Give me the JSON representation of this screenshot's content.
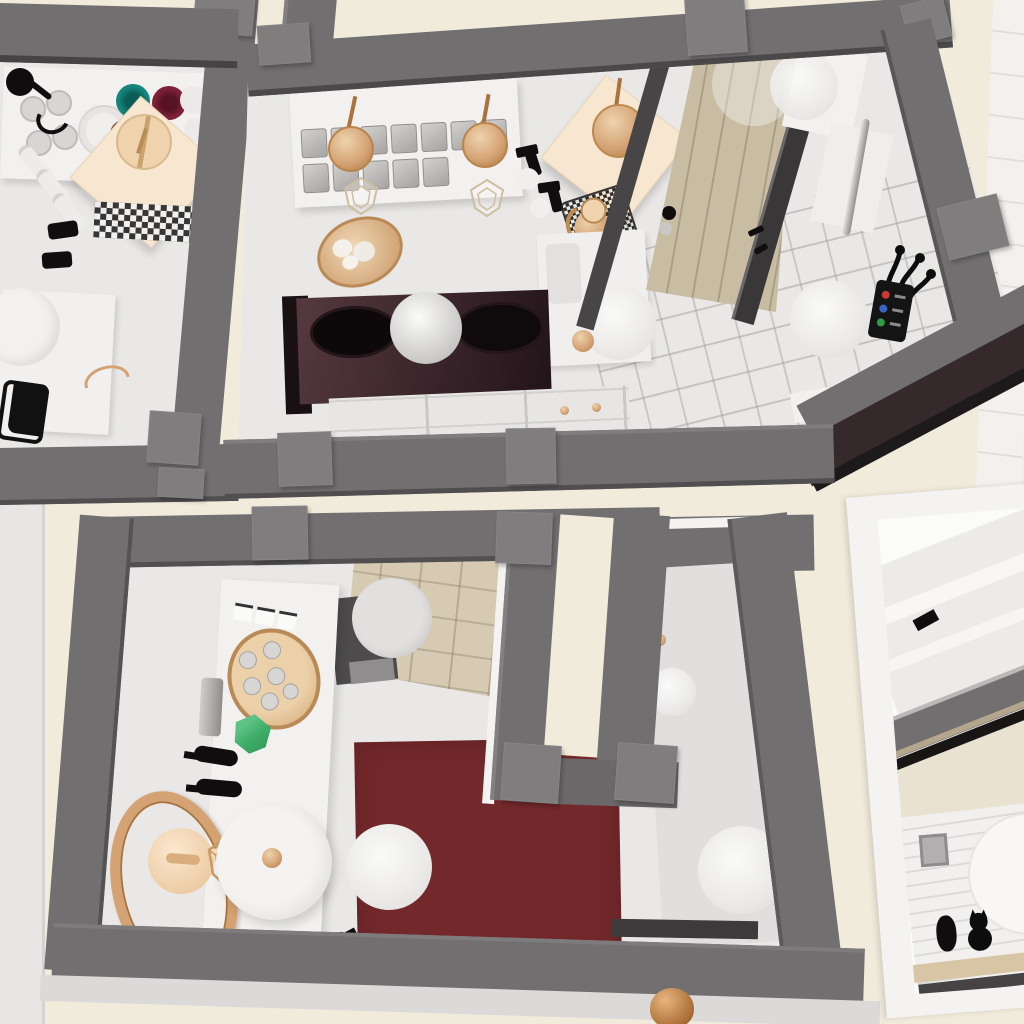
{
  "scene": {
    "type": "3d-interior-render-top-down",
    "setting": "Top-down 3D render of a miniature cafe interior with gray walls, cream floors, copper accents, a dark red rug and a tan door",
    "colors": {
      "floor_cream": "#f1ebdc",
      "exterior_white": "#f2f1ed",
      "wall_top": "#716f70",
      "wall_side": "#4b494a",
      "wall_cap": "#7f7d7e",
      "wall_dark": "#39383a",
      "room_floor": "#e9e8e6",
      "cutout_floor": "#e0dfdd",
      "counter_white": "#f2f1ef",
      "cabinet_white": "#e7e6e4",
      "dark_counter_a": "#55393f",
      "dark_counter_b": "#22141a",
      "black": "#0f0d0e",
      "door_tan": "#c8bca3",
      "door_frame": "#474546",
      "copper": "#d3a172",
      "copper_light": "#eed3ad",
      "copper_deep": "#a9733f",
      "cream_table": "#f8e7d0",
      "teal": "#16857c",
      "maroon": "#7c2137",
      "brown": "#8a5a35",
      "cream_cup": "#efe3c2",
      "green_gem": "#3fae6a",
      "rug_red": "#73282b",
      "beige_tile": "#d7cab2",
      "silver": "#b9b8b6",
      "glass": "#c9c8c6",
      "frame_white": "#f4f3f1",
      "panel_cream": "#e9e2d1",
      "btn_red": "#c43b34",
      "btn_blue": "#3565c0",
      "btn_green": "#2f9e44"
    },
    "rooms": [
      {
        "name": "pantry-room",
        "position": "top-left",
        "objects": [
          "white shelf with glasses and plate stack",
          "teal cup",
          "maroon cup",
          "brown cup",
          "cream cup",
          "white cups",
          "cream square table",
          "wooden stool",
          "black faucet",
          "black-white patterned tile mat",
          "white bottles",
          "black jars",
          "white cabinet with copper handle",
          "white crock"
        ]
      },
      {
        "name": "bar-room",
        "position": "top-center",
        "objects": [
          "bar counter with rows of glasses",
          "two copper pendant discs",
          "wire pendant lamps",
          "copper oval tray with ice",
          "black spray bottles",
          "cream square table",
          "copper stool",
          "copper kettle",
          "wire mesh basket",
          "sink cabinet",
          "dark counter with two black burners",
          "white sphere lamp",
          "drawer cabinet with copper knobs",
          "white round stools",
          "tan paneled door with dark frames",
          "door knob",
          "wall shelves",
          "chrome rail",
          "black coat hooks",
          "control panel with red blue green buttons"
        ]
      },
      {
        "name": "lounge-room",
        "position": "bottom-left",
        "objects": [
          "white sideboard",
          "menu cards",
          "copper tray with glasses",
          "silver grinder",
          "green faceted box",
          "black bottles",
          "large copper hoop",
          "cream teapot",
          "copper wire stool",
          "large round white table with copper dot",
          "gray stool",
          "beige tiled corner",
          "dark red rug",
          "white stools",
          "entry corridor walls with cream doorway",
          "dark wall insert",
          "copper jar at bottom edge"
        ]
      },
      {
        "name": "side-view-room",
        "position": "bottom-right",
        "objects": [
          "white frame",
          "light roof planes",
          "gray beam",
          "black beam",
          "cream panel",
          "shiplap striped wall",
          "round white mirror",
          "small picture frame",
          "black cat silhouette",
          "wooden shelf"
        ]
      }
    ]
  }
}
